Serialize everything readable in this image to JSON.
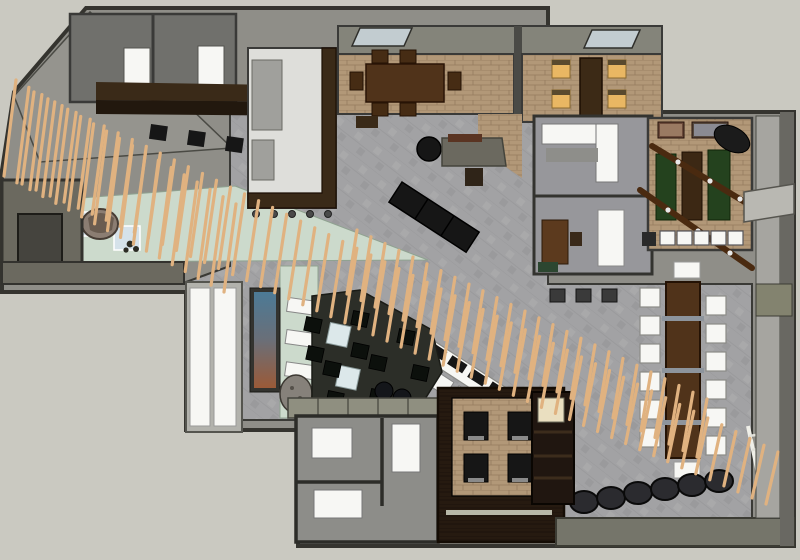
{
  "meta": {
    "description": "Top-down 3D rendered floor plan (sketch-render style) of a restaurant and lounge interior. A long diagonal screen of thin tan wooden slats sweeps from the upper-left corner across the grey tiled hall to the lower-right corner. Around it sit private dining rooms with brick floors, a games room with green tables, a kitchen, a zen corner with a boulder, a dark-floored lounge, booth seating and a long communal table.",
    "view": "top-down axonometric render",
    "visible_text": "none"
  },
  "palette": {
    "canvas": "#cac9c1",
    "wallFace": "#8f8e88",
    "wallDark": "#35342f",
    "wallOlive": "#6b695f",
    "floorTile": "#a2a2a4",
    "floorBrick": "#b29878",
    "floorMint": "#ccdacc",
    "floorDark": "#2c2e28",
    "floorWood": "#261a10",
    "woodDark": "#3a2a18",
    "tableWood": "#50331a",
    "greenTable": "#24421e",
    "amberChair": "#e9b763",
    "whiteFurniture": "#f7f7f4",
    "blackFurniture": "#161616",
    "oliveBand": "#75756a",
    "muralBlue": "#4c7a96",
    "muralRust": "#9a5a38",
    "slat": "#e0b280"
  },
  "scene": {
    "regions": [
      {
        "id": "storage-closets",
        "desc": "two small rooms top-left with white doors"
      },
      {
        "id": "kitchen",
        "desc": "white floor, grey counters, dark L-shaped bar with stools"
      },
      {
        "id": "dining-room-a",
        "desc": "brick floor, dark wood table, six wood chairs, skylight"
      },
      {
        "id": "dining-room-b",
        "desc": "brick floor, narrow table, four amber-lit chairs, skylight"
      },
      {
        "id": "games-room",
        "desc": "brick floor, green shuffleboard tables, beam lights, wall art, bar with five white stools"
      },
      {
        "id": "pantry-office-rooms",
        "desc": "two small grey rooms with white counters and desk"
      },
      {
        "id": "zen-corner",
        "desc": "mint floor, boulder, two pale blue mats"
      },
      {
        "id": "lounge",
        "desc": "dark floor, two white tables, black chairs, round poufs, mural wall, white benches, rock"
      },
      {
        "id": "main-hall",
        "desc": "grey tiled floor crossed by diagonal slat screen, black bench, buffet counter with white chairs"
      },
      {
        "id": "communal-table",
        "desc": "long dark wood table with white chairs on both sides"
      },
      {
        "id": "booth-corner",
        "desc": "dark wood floor, brick platform, four black booth chairs"
      },
      {
        "id": "restrooms",
        "desc": "grey rooms with white fixtures"
      },
      {
        "id": "barrel-row",
        "desc": "six dark cylinder stools along bottom-right"
      }
    ]
  },
  "slats": {
    "color": "#e0b280",
    "width": 3.2,
    "bands": [
      {
        "x1": 28,
        "y1": 138,
        "x2": 772,
        "y2": 478,
        "count": 54,
        "len1": 92,
        "len2": 52,
        "lean": 6
      },
      {
        "x1": 10,
        "y1": 128,
        "x2": 230,
        "y2": 248,
        "count": 18,
        "len1": 96,
        "len2": 88,
        "lean": 6
      },
      {
        "x1": 352,
        "y1": 262,
        "x2": 702,
        "y2": 428,
        "count": 26,
        "len1": 64,
        "len2": 58,
        "lean": 5
      }
    ]
  }
}
